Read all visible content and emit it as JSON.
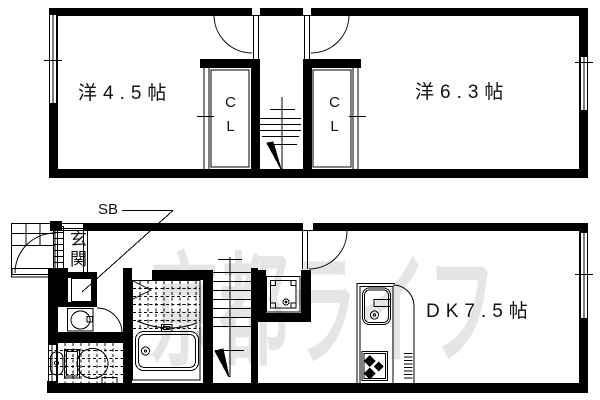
{
  "title": "apartment-floor-plan",
  "watermark": "京都ライフ",
  "colors": {
    "line": "#000000",
    "background": "#ffffff",
    "watermark": "#e5e5e5"
  },
  "labels": {
    "room_2f_left": "洋4.5帖",
    "room_2f_right": "洋6.3帖",
    "closet": "CL",
    "room_dk": "DK7.5帖",
    "entrance": "玄関",
    "shoe_box": "SB"
  },
  "floors": [
    {
      "id": "2F",
      "rooms": [
        {
          "name": "western-room",
          "label": "洋4.5帖",
          "size_jo": 4.5
        },
        {
          "name": "western-room",
          "label": "洋6.3帖",
          "size_jo": 6.3
        },
        {
          "name": "closet",
          "label": "CL"
        },
        {
          "name": "closet",
          "label": "CL"
        },
        {
          "name": "staircase-down"
        }
      ]
    },
    {
      "id": "1F",
      "rooms": [
        {
          "name": "entrance-genkan",
          "label": "玄関"
        },
        {
          "name": "shoe-box",
          "label": "SB"
        },
        {
          "name": "dining-kitchen",
          "label": "DK7.5帖",
          "size_jo": 7.5
        },
        {
          "name": "washroom-vanity"
        },
        {
          "name": "toilet"
        },
        {
          "name": "bathroom-with-tub"
        },
        {
          "name": "staircase-down"
        },
        {
          "name": "washing-machine-pan"
        }
      ]
    }
  ],
  "fixtures": [
    "entrance-door",
    "porch-tiles",
    "shoe-box",
    "vanity-basin",
    "toilet-bowl",
    "bathtub",
    "folding-bath-door",
    "kitchen-sink",
    "gas-stove",
    "washing-machine-pan",
    "stairs-up",
    "stairs-down",
    "windows",
    "closet-doors"
  ]
}
